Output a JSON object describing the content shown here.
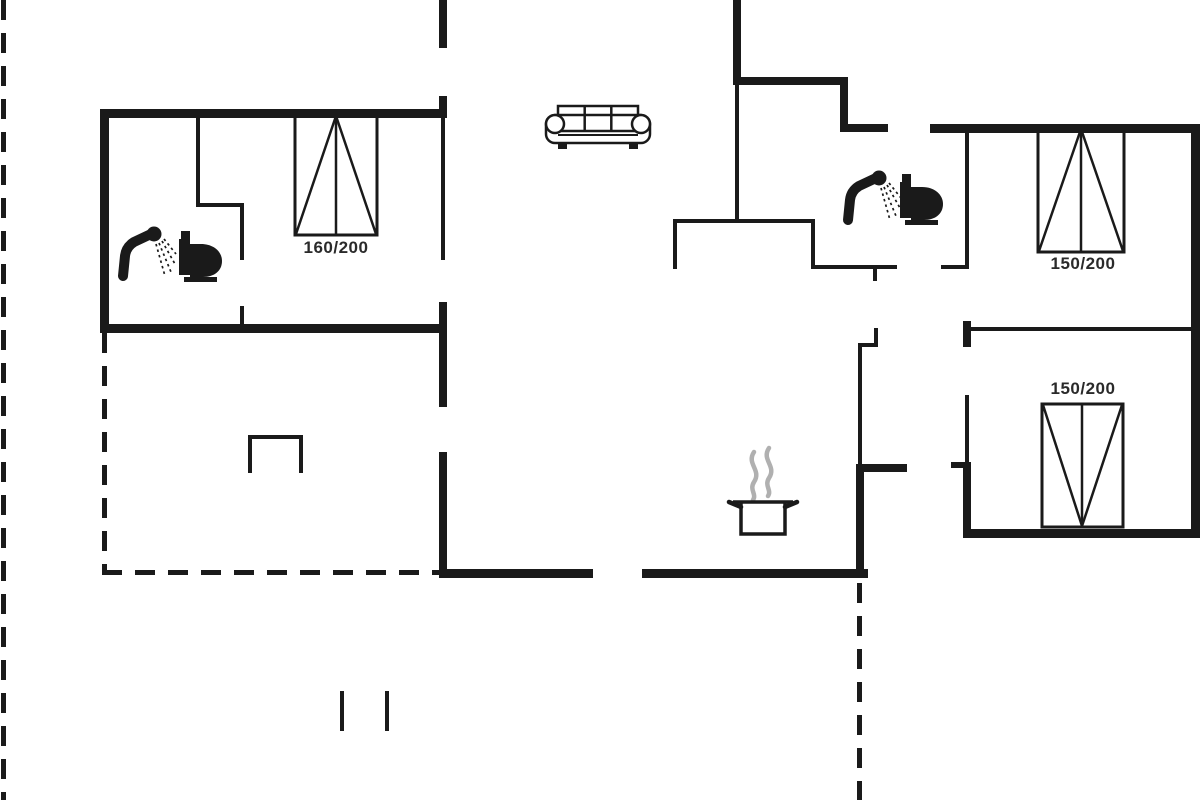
{
  "plan": {
    "type": "floor-plan",
    "wall_color": "#1a1a1a",
    "steam_color": "#b0b0b0",
    "label_color": "#2a2a2a",
    "background": "#ffffff"
  },
  "beds": [
    {
      "room": "bedroom-left",
      "size_label": "160/200"
    },
    {
      "room": "bedroom-top-right",
      "size_label": "150/200"
    },
    {
      "room": "bedroom-bottom-right",
      "size_label": "150/200"
    }
  ],
  "fixtures": [
    {
      "name": "shower-icon",
      "room": "bathroom-left"
    },
    {
      "name": "toilet-icon",
      "room": "bathroom-left"
    },
    {
      "name": "shower-icon",
      "room": "bathroom-right"
    },
    {
      "name": "toilet-icon",
      "room": "bathroom-right"
    },
    {
      "name": "sofa-icon",
      "room": "living-room"
    },
    {
      "name": "cooking-pot-icon",
      "room": "kitchen"
    },
    {
      "name": "fireplace-icon",
      "room": "terrace-room"
    }
  ]
}
